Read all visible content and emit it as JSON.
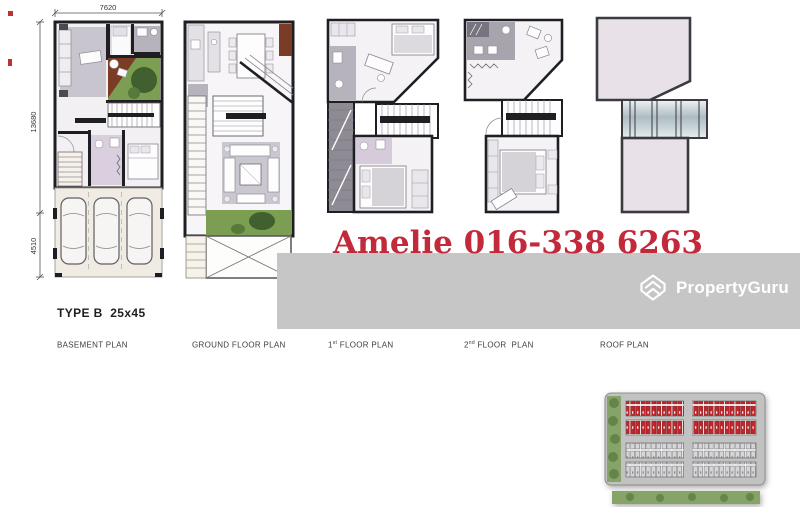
{
  "sheet": {
    "unit_type_label": "TYPE B  25x45",
    "watermark": {
      "text": "Amelie 016-338 6263",
      "color": "#c2293a"
    },
    "brand": {
      "name": "PropertyGuru",
      "band_color": "#c6c6c6",
      "text_color": "#ffffff"
    }
  },
  "dimensions": {
    "top_width": "7620",
    "side_upper_height": "13680",
    "side_lower_height": "4510"
  },
  "plan_labels": [
    {
      "id": "basement",
      "num": "",
      "sup": "",
      "rest": "BASEMENT PLAN"
    },
    {
      "id": "ground",
      "num": "",
      "sup": "",
      "rest": "GROUND FLOOR PLAN"
    },
    {
      "id": "first",
      "num": "1",
      "sup": "st",
      "rest": " FLOOR PLAN"
    },
    {
      "id": "second",
      "num": "2",
      "sup": "nd",
      "rest": " FLOOR  PLAN"
    },
    {
      "id": "roof",
      "num": "",
      "sup": "",
      "rest": "ROOF PLAN"
    }
  ],
  "site_map": {
    "highlighted_rows_color": "#c0272d",
    "other_rows_color": "#d6d6d8",
    "greenery_color": "#86a468",
    "road_color": "#c2c2c2"
  }
}
